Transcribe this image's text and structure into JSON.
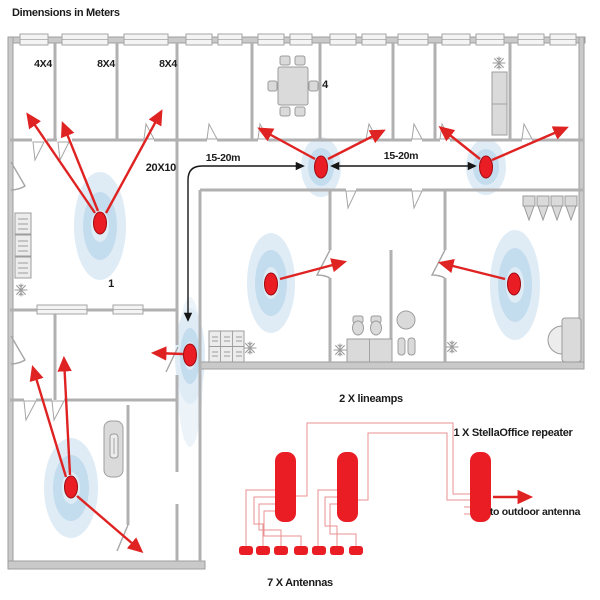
{
  "title": "Dimensions in Meters",
  "floor_plan": {
    "room_labels": [
      {
        "id": "room-4x4",
        "text": "4X4"
      },
      {
        "id": "room-8x4-a",
        "text": "8X4"
      },
      {
        "id": "room-8x4-b",
        "text": "8X4"
      },
      {
        "id": "meeting-room",
        "text": "4"
      },
      {
        "id": "large-room",
        "text": "20X10"
      },
      {
        "id": "large-room-number",
        "text": "1"
      }
    ],
    "distance_labels": [
      {
        "text": "15-20m"
      },
      {
        "text": "15-20m"
      }
    ],
    "ceiling_antenna_count": 7
  },
  "schematic": {
    "lineamps_label": "2 X lineamps",
    "repeater_label": "1 X StellaOffice repeater",
    "outdoor_label": "to outdoor antenna",
    "antennas_label": "7 X Antennas"
  },
  "colors": {
    "antenna_red": "#ea1c24",
    "arrow_red": "#df2322",
    "distance_black": "#161616",
    "coverage_outer": "#dfecf6",
    "coverage_inner": "#c3dcee",
    "wall_gray": "#b1b1b1",
    "wire_red": "#e89090"
  }
}
